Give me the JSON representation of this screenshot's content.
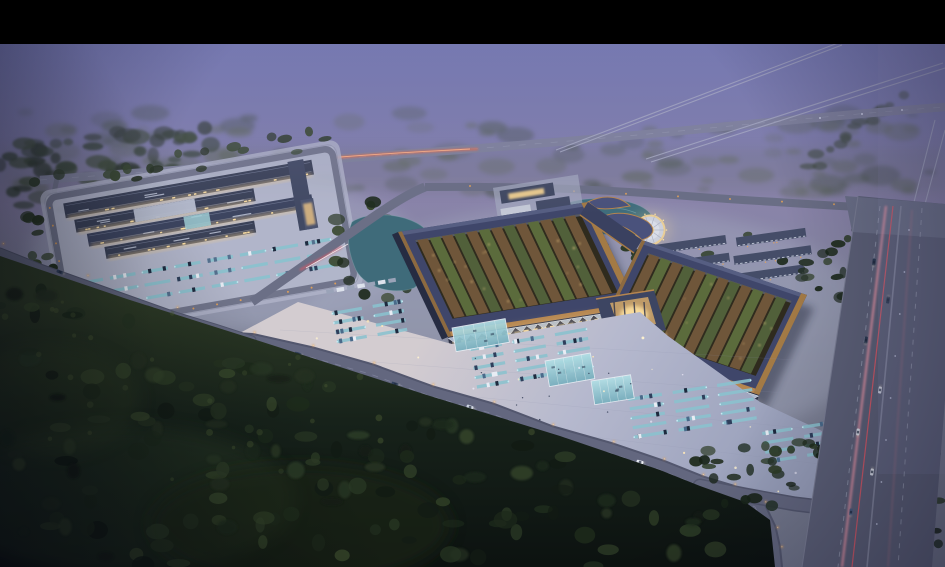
{
  "meta": {
    "type": "architectural-aerial-rendering",
    "time_of_day": "dusk",
    "view": "birds-eye",
    "description": "Dusk aerial rendering of a large market/logistics complex: two V-shaped market halls with lit courtyards, entry plaza with parking rows, a logistics campus to the west, ponds, a circular fountain plaza, dormitory rows, a highway with light trails on the east and dark forest in the foreground, all under a purple evening haze with a black letterbox bar at the top."
  },
  "letterbox": {
    "top_bar_height_px": 44
  },
  "colors": {
    "black": "#000000",
    "haze_top": "#6c72b0",
    "haze_mid": "#8983a9",
    "ground": "#7b7f92",
    "site_pad": "#a6abc2",
    "plaza_near": "#d3ccd0",
    "plaza_mid": "#b6b9ce",
    "plaza_far": "#989fba",
    "roof": "#3f466a",
    "roof_highlight": "#565e82",
    "bronze": "#b5854f",
    "courtyard": "#2f2b1e",
    "stall_brown": "#6f563a",
    "stall_green": "#5b6b3c",
    "glow": "#efd7a4",
    "glow_bright": "#ffe2a4",
    "lamp_warm": "#e8a355",
    "water": "#3f6b7a",
    "teal": "#8ac2ce",
    "glass": "#9fd3dc",
    "road": "#63677f",
    "road_dark": "#53576e",
    "road_pale": "#a9adc4",
    "trail_red": "#d55a68",
    "trail_pink": "#e795a6",
    "streak_orange": "#e06a48",
    "forest_top": "#2e3b26",
    "forest_deep": "#0c1210",
    "tree": "#253321",
    "campus_roof": "#3a4157",
    "campus_white": "#b7bed0",
    "car_white": "#e8ecf4"
  },
  "scene": {
    "landmarks": [
      "black-letterbox-bar",
      "evening-haze-sky",
      "distant-fields",
      "distant-tree-line",
      "arterial-road",
      "branch-roads",
      "logistics-campus",
      "campus-parking-lot",
      "pond-west",
      "pond-north",
      "service-road",
      "office-pavilions",
      "circular-fountain-plaza",
      "dormitory-rows",
      "market-hall-west-wing",
      "market-hall-east-wing",
      "central-gate-pavilion",
      "courtyard-stall-rows",
      "entry-plaza",
      "plaza-parking-rows",
      "glass-canopies",
      "access-road",
      "foreground-forest",
      "highway",
      "traffic-light-trails",
      "street-lamps",
      "cars"
    ]
  }
}
